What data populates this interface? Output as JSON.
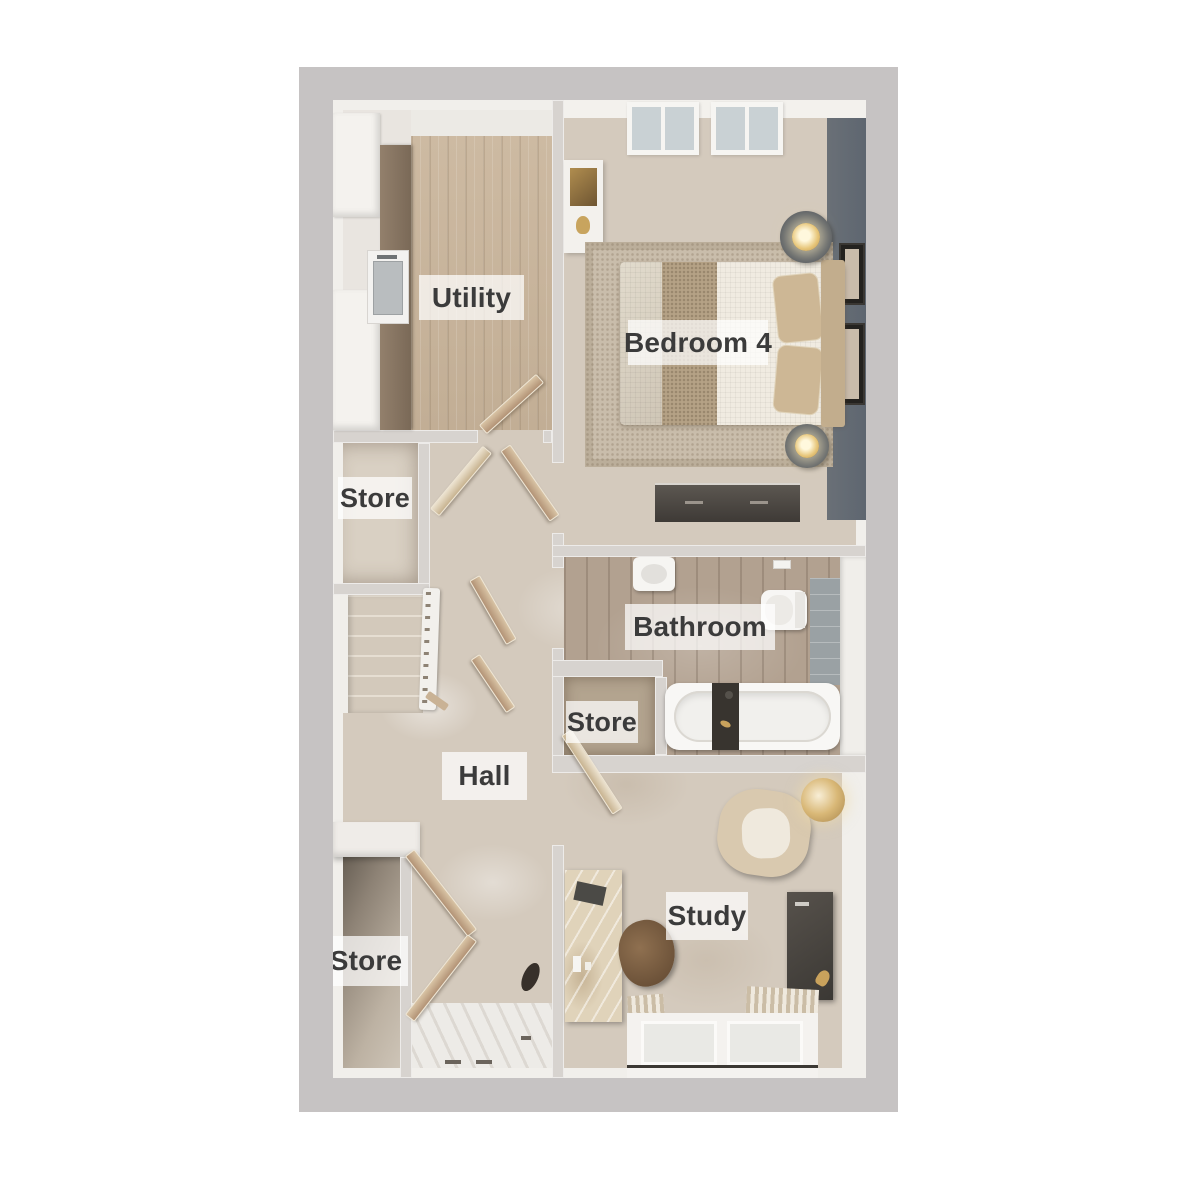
{
  "plan": {
    "kind": "floor-plan",
    "floor": "3D top-down render"
  },
  "rooms": {
    "utility": {
      "label": "Utility"
    },
    "bedroom4": {
      "label": "Bedroom 4"
    },
    "store_upper": {
      "label": "Store"
    },
    "bathroom": {
      "label": "Bathroom"
    },
    "store_middle": {
      "label": "Store"
    },
    "hall": {
      "label": "Hall"
    },
    "store_lower": {
      "label": "Store"
    },
    "study": {
      "label": "Study"
    }
  },
  "colors": {
    "frame": "#c6c3c3",
    "wall": "#d7d3cf",
    "wall_face": "#f1efeb",
    "carpet": "#d4cabd",
    "wood_floor": "#c8b59e",
    "counter_wood": "#82705d",
    "bath_floor": "#b2a190",
    "accent_wall": "#5e6670",
    "door_wood": "#c4aa8a",
    "dark_furniture": "#45413c",
    "gold": "#c9a25c",
    "window_glass": "#c9d1d4",
    "label_text": "#3b3b3b",
    "label_bg": "#ffffff"
  }
}
